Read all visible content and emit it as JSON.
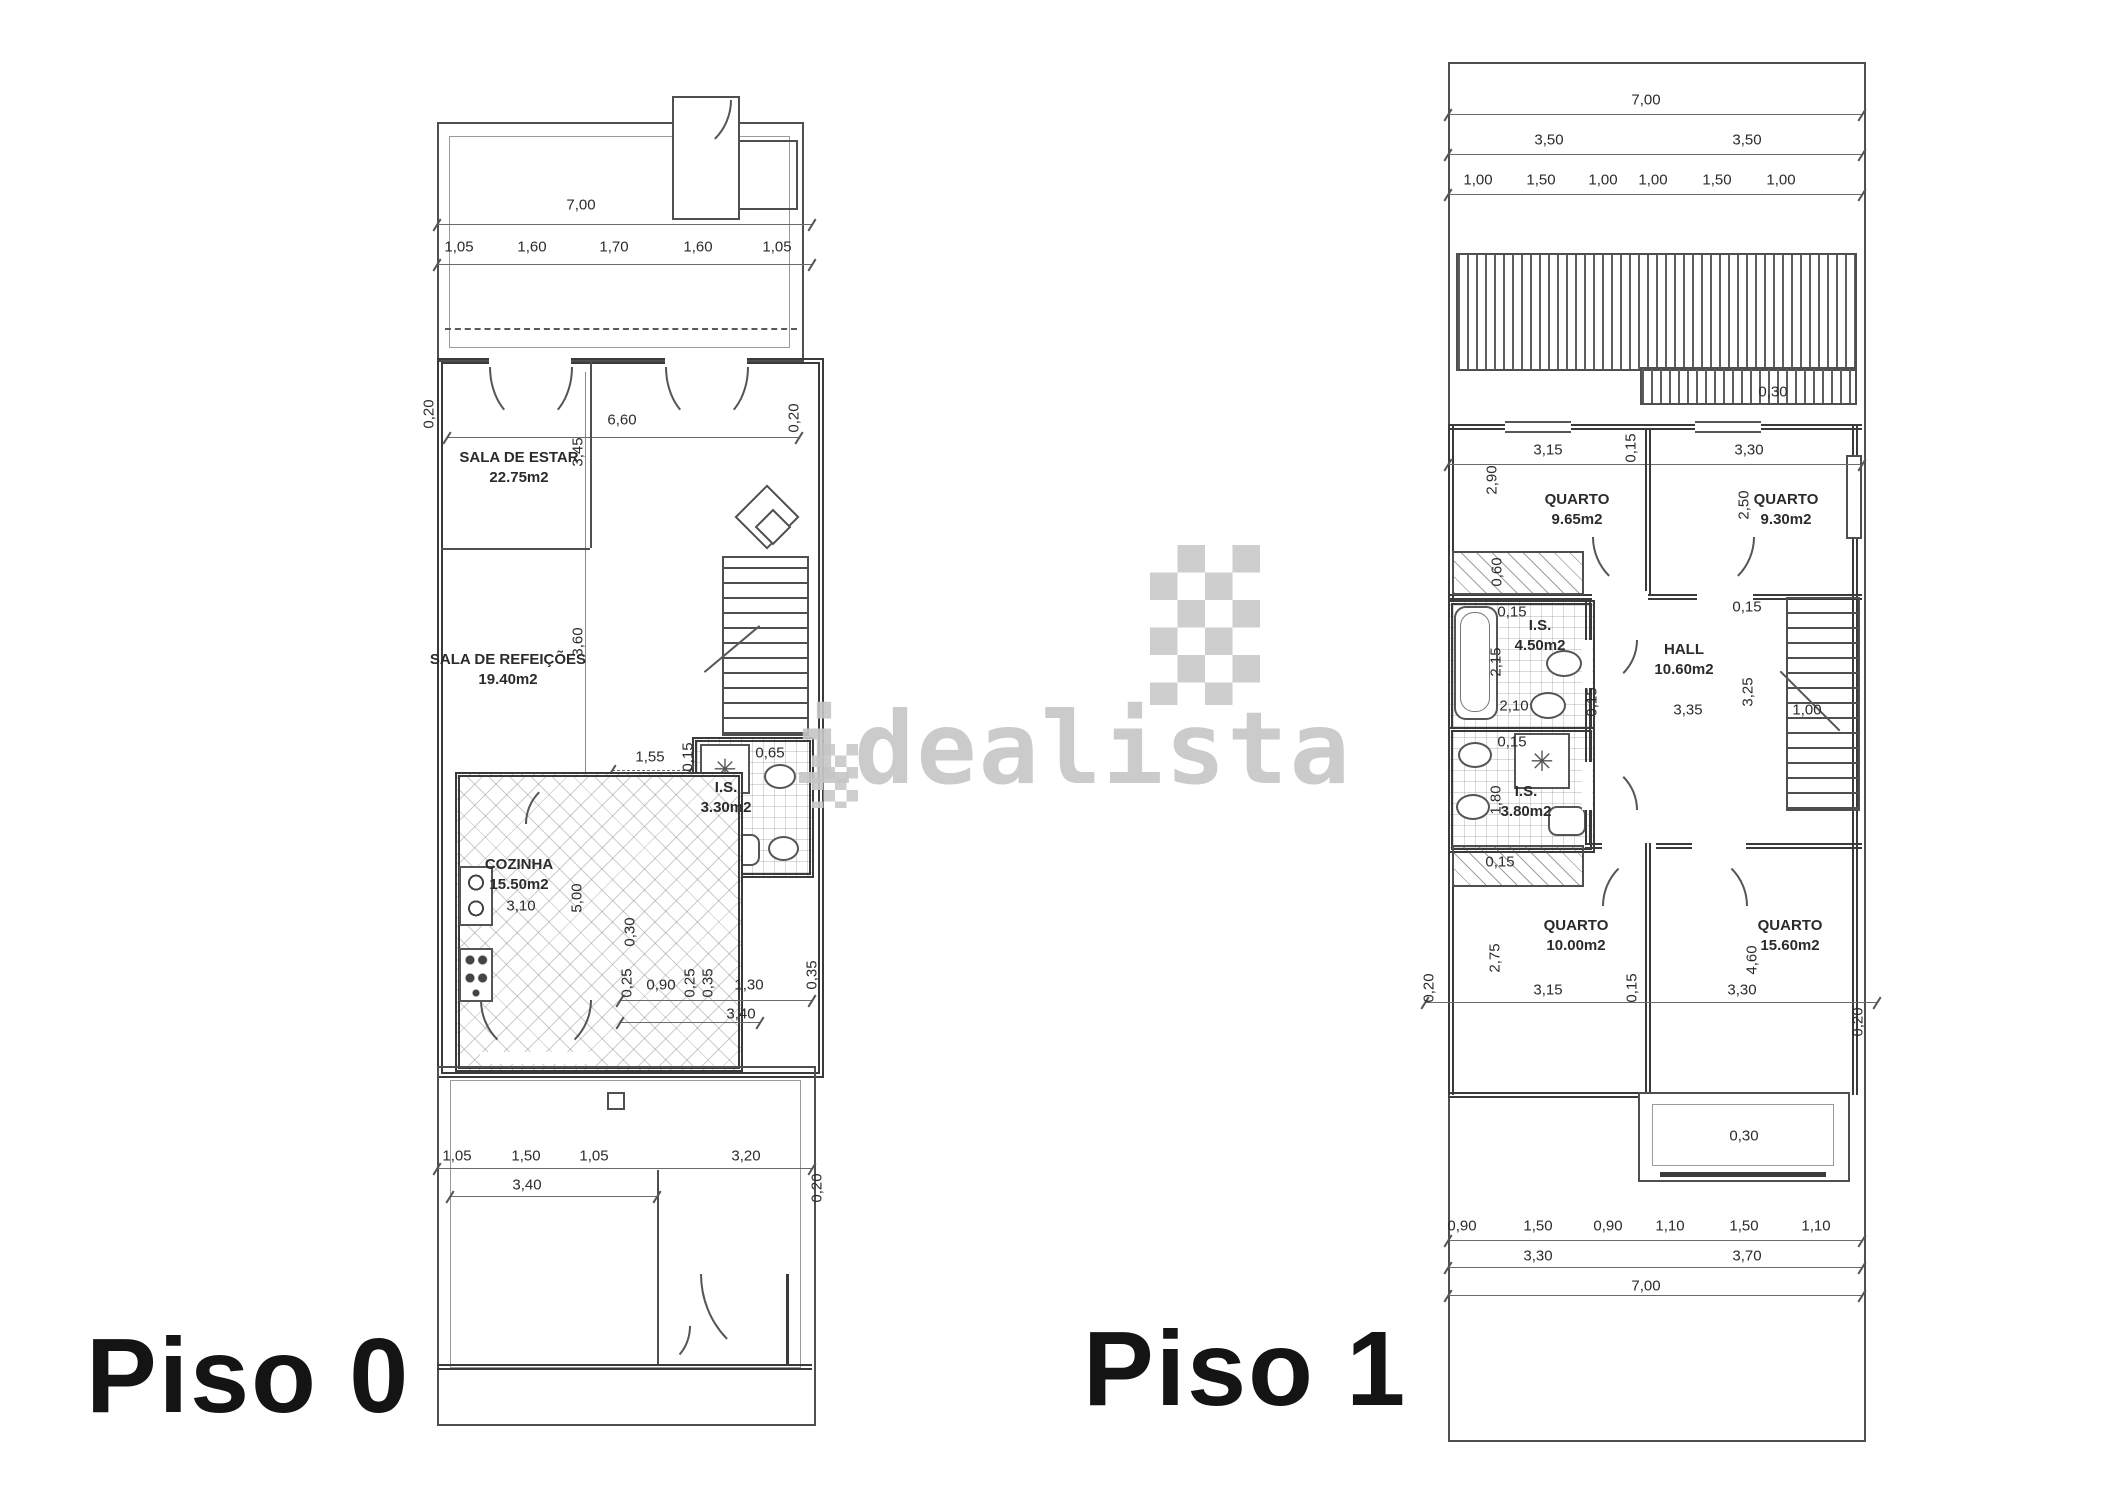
{
  "watermark": {
    "text": "idealista",
    "color": "#c6c6c6"
  },
  "colors": {
    "wall": "#3a3a3a",
    "line": "#555555",
    "dim_text": "#2b2b2b",
    "title": "#141414"
  },
  "piso0": {
    "title": "Piso 0",
    "rooms": [
      {
        "lines": [
          "SALA DE ESTAR",
          "22.75m2"
        ],
        "x": 519,
        "y": 448
      },
      {
        "lines": [
          "SALA DE REFEIÇÕES",
          "19.40m2"
        ],
        "x": 508,
        "y": 650
      },
      {
        "lines": [
          "I.S.",
          "3.30m2"
        ],
        "x": 726,
        "y": 778
      },
      {
        "lines": [
          "COZINHA",
          "15.50m2"
        ],
        "x": 519,
        "y": 855
      }
    ],
    "dims": [
      {
        "t": "7,00",
        "x": 581,
        "y": 205
      },
      {
        "t": "1,05",
        "x": 459,
        "y": 247
      },
      {
        "t": "1,60",
        "x": 532,
        "y": 247
      },
      {
        "t": "1,70",
        "x": 614,
        "y": 247
      },
      {
        "t": "1,60",
        "x": 698,
        "y": 247
      },
      {
        "t": "1,05",
        "x": 777,
        "y": 247
      },
      {
        "t": "6,60",
        "x": 622,
        "y": 420
      },
      {
        "t": "0,20",
        "x": 429,
        "y": 414,
        "r": 1
      },
      {
        "t": "0,20",
        "x": 794,
        "y": 418,
        "r": 1
      },
      {
        "t": "3,45",
        "x": 578,
        "y": 452,
        "r": 1
      },
      {
        "t": "3,60",
        "x": 578,
        "y": 642,
        "r": 1
      },
      {
        "t": "1,55",
        "x": 650,
        "y": 757
      },
      {
        "t": "0,15",
        "x": 688,
        "y": 757,
        "r": 1
      },
      {
        "t": "0,65",
        "x": 770,
        "y": 753
      },
      {
        "t": "3,10",
        "x": 521,
        "y": 906
      },
      {
        "t": "5,00",
        "x": 577,
        "y": 898,
        "r": 1
      },
      {
        "t": "0,30",
        "x": 630,
        "y": 932,
        "r": 1
      },
      {
        "t": "0,25",
        "x": 627,
        "y": 983,
        "r": 1
      },
      {
        "t": "0,90",
        "x": 661,
        "y": 985
      },
      {
        "t": "0,25",
        "x": 690,
        "y": 983,
        "r": 1
      },
      {
        "t": "0,35",
        "x": 708,
        "y": 983,
        "r": 1
      },
      {
        "t": "1,30",
        "x": 749,
        "y": 985
      },
      {
        "t": "0,35",
        "x": 812,
        "y": 975,
        "r": 1
      },
      {
        "t": "3,40",
        "x": 741,
        "y": 1014
      },
      {
        "t": "1,05",
        "x": 457,
        "y": 1156
      },
      {
        "t": "1,50",
        "x": 526,
        "y": 1156
      },
      {
        "t": "1,05",
        "x": 594,
        "y": 1156
      },
      {
        "t": "3,40",
        "x": 527,
        "y": 1185
      },
      {
        "t": "3,20",
        "x": 746,
        "y": 1156
      },
      {
        "t": "0,20",
        "x": 817,
        "y": 1188,
        "r": 1
      }
    ]
  },
  "piso1": {
    "title": "Piso 1",
    "rooms": [
      {
        "lines": [
          "QUARTO",
          "9.65m2"
        ],
        "x": 1577,
        "y": 490
      },
      {
        "lines": [
          "QUARTO",
          "9.30m2"
        ],
        "x": 1786,
        "y": 490
      },
      {
        "lines": [
          "I.S.",
          "4.50m2"
        ],
        "x": 1540,
        "y": 616
      },
      {
        "lines": [
          "HALL",
          "10.60m2"
        ],
        "x": 1684,
        "y": 640
      },
      {
        "lines": [
          "I.S.",
          "3.80m2"
        ],
        "x": 1526,
        "y": 782
      },
      {
        "lines": [
          "QUARTO",
          "10.00m2"
        ],
        "x": 1576,
        "y": 916
      },
      {
        "lines": [
          "QUARTO",
          "15.60m2"
        ],
        "x": 1790,
        "y": 916
      }
    ],
    "dims": [
      {
        "t": "7,00",
        "x": 1646,
        "y": 100
      },
      {
        "t": "3,50",
        "x": 1549,
        "y": 140
      },
      {
        "t": "3,50",
        "x": 1747,
        "y": 140
      },
      {
        "t": "1,00",
        "x": 1478,
        "y": 180
      },
      {
        "t": "1,50",
        "x": 1541,
        "y": 180
      },
      {
        "t": "1,00",
        "x": 1603,
        "y": 180
      },
      {
        "t": "1,00",
        "x": 1653,
        "y": 180
      },
      {
        "t": "1,50",
        "x": 1717,
        "y": 180
      },
      {
        "t": "1,00",
        "x": 1781,
        "y": 180
      },
      {
        "t": "0,30",
        "x": 1773,
        "y": 392
      },
      {
        "t": "3,15",
        "x": 1548,
        "y": 450
      },
      {
        "t": "0,15",
        "x": 1631,
        "y": 448,
        "r": 1
      },
      {
        "t": "3,30",
        "x": 1749,
        "y": 450
      },
      {
        "t": "2,90",
        "x": 1492,
        "y": 480,
        "r": 1
      },
      {
        "t": "2,50",
        "x": 1744,
        "y": 505,
        "r": 1
      },
      {
        "t": "0,60",
        "x": 1497,
        "y": 572,
        "r": 1
      },
      {
        "t": "0,15",
        "x": 1512,
        "y": 612
      },
      {
        "t": "2,15",
        "x": 1496,
        "y": 662,
        "r": 1
      },
      {
        "t": "2,10",
        "x": 1514,
        "y": 706
      },
      {
        "t": "0,15",
        "x": 1592,
        "y": 702,
        "r": 1
      },
      {
        "t": "0,15",
        "x": 1747,
        "y": 607
      },
      {
        "t": "3,35",
        "x": 1688,
        "y": 710
      },
      {
        "t": "3,25",
        "x": 1748,
        "y": 692,
        "r": 1
      },
      {
        "t": "1,00",
        "x": 1807,
        "y": 710
      },
      {
        "t": "0,15",
        "x": 1512,
        "y": 742
      },
      {
        "t": "1,80",
        "x": 1496,
        "y": 800,
        "r": 1
      },
      {
        "t": "0,15",
        "x": 1500,
        "y": 862
      },
      {
        "t": "2,75",
        "x": 1495,
        "y": 958,
        "r": 1
      },
      {
        "t": "3,15",
        "x": 1548,
        "y": 990
      },
      {
        "t": "0,15",
        "x": 1632,
        "y": 988,
        "r": 1
      },
      {
        "t": "3,30",
        "x": 1742,
        "y": 990
      },
      {
        "t": "4,60",
        "x": 1752,
        "y": 960,
        "r": 1
      },
      {
        "t": "0,20",
        "x": 1429,
        "y": 988,
        "r": 1
      },
      {
        "t": "0,20",
        "x": 1858,
        "y": 1022,
        "r": 1
      },
      {
        "t": "0,30",
        "x": 1744,
        "y": 1136
      },
      {
        "t": "0,90",
        "x": 1462,
        "y": 1226
      },
      {
        "t": "1,50",
        "x": 1538,
        "y": 1226
      },
      {
        "t": "0,90",
        "x": 1608,
        "y": 1226
      },
      {
        "t": "1,10",
        "x": 1670,
        "y": 1226
      },
      {
        "t": "1,50",
        "x": 1744,
        "y": 1226
      },
      {
        "t": "1,10",
        "x": 1816,
        "y": 1226
      },
      {
        "t": "3,30",
        "x": 1538,
        "y": 1256
      },
      {
        "t": "3,70",
        "x": 1747,
        "y": 1256
      },
      {
        "t": "7,00",
        "x": 1646,
        "y": 1286
      }
    ]
  }
}
